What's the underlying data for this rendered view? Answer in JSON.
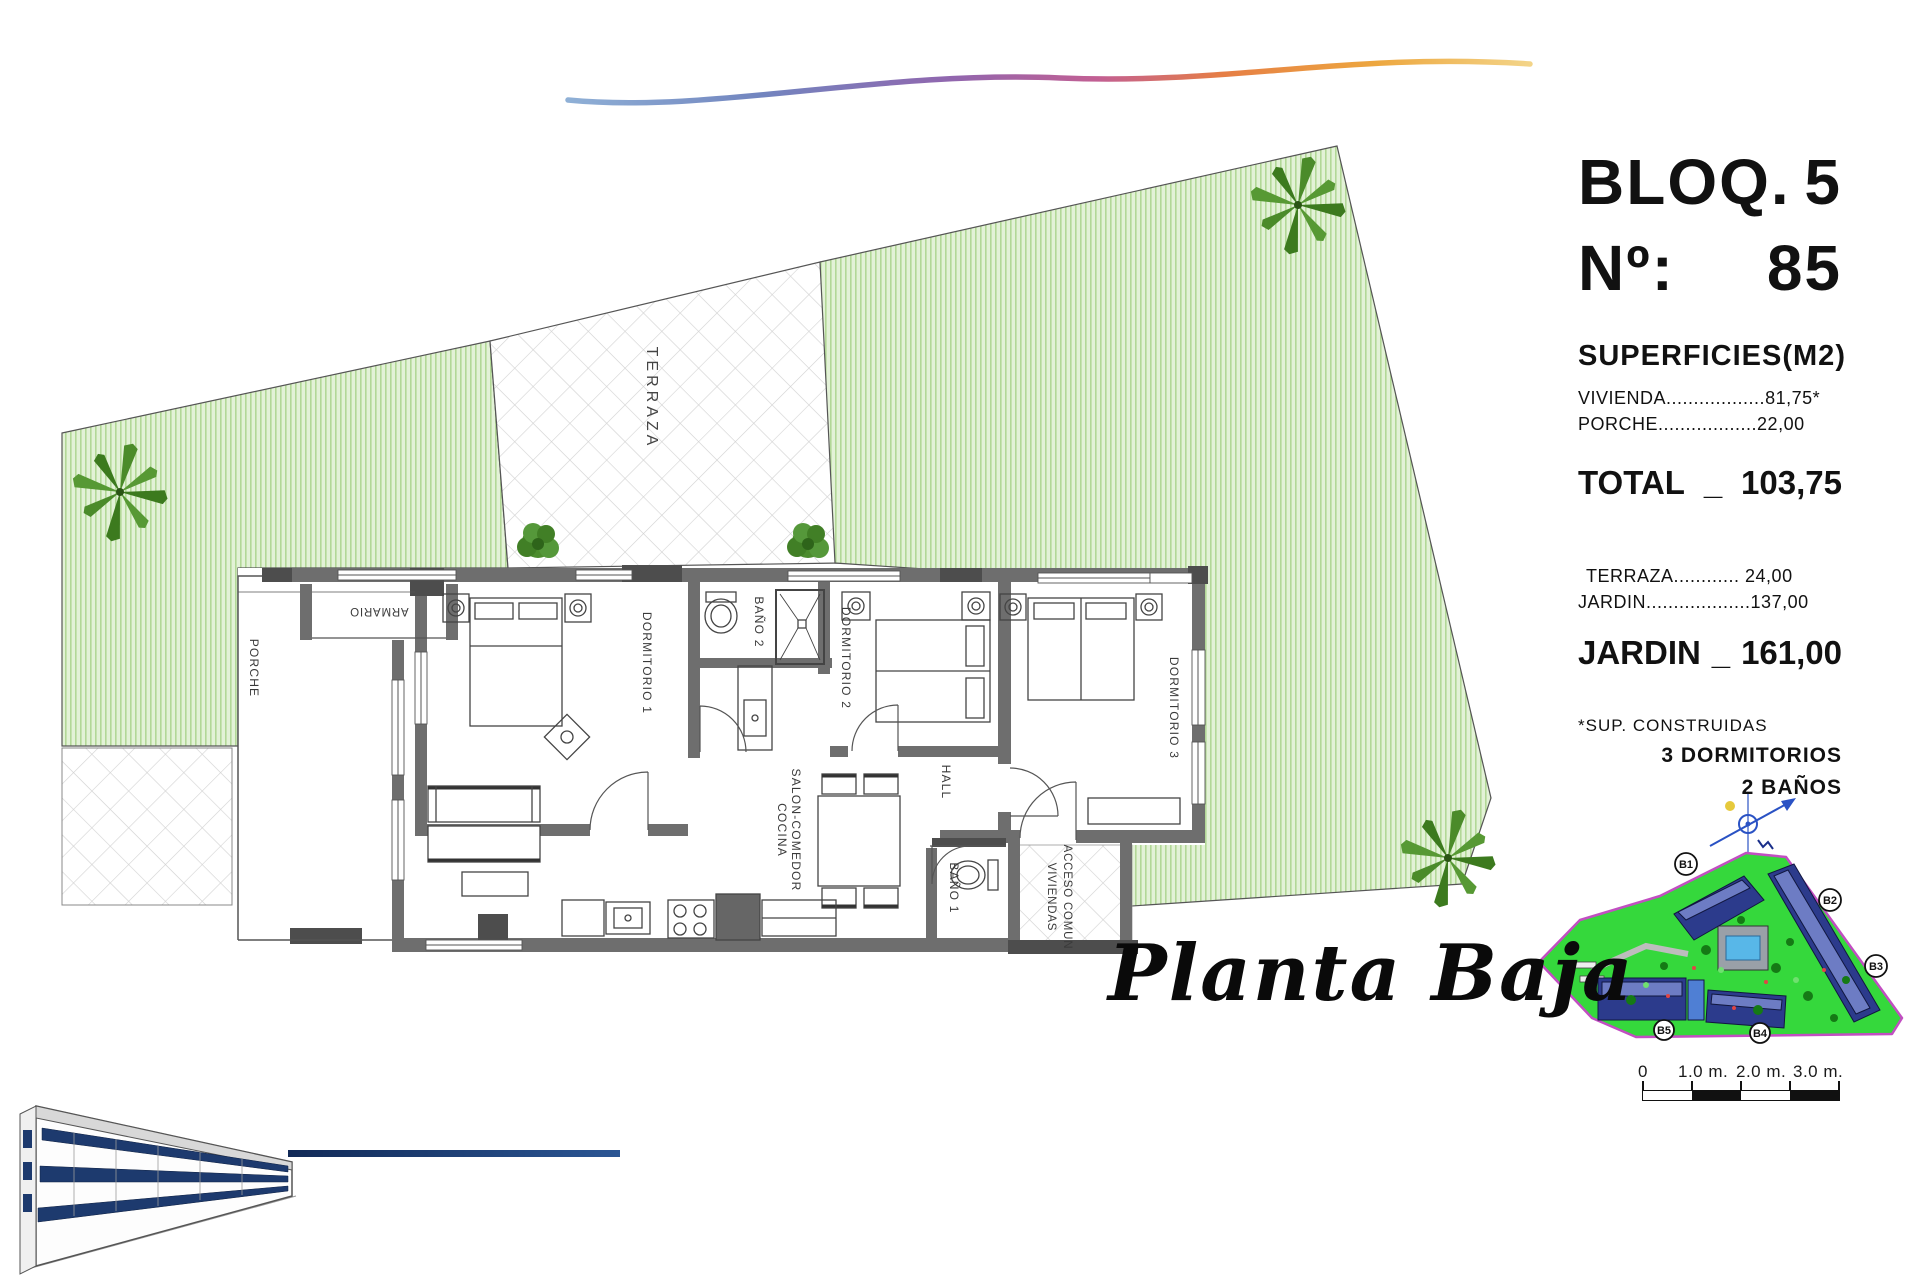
{
  "header": {
    "block": "BLOQ.",
    "block_num": "5",
    "num_label": "Nº:",
    "num_value": "85"
  },
  "surfaces": {
    "title": "SUPERFICIES(M2)",
    "rows": [
      {
        "label": "VIVIENDA",
        "dots": "..................",
        "value": "81,75*"
      },
      {
        "label": "PORCHE",
        "dots": "..................",
        "value": "22,00"
      }
    ],
    "total": {
      "label": "TOTAL",
      "sep": "_",
      "value": "103,75"
    },
    "outdoor": [
      {
        "label": "TERRAZA",
        "dots": "............ ",
        "value": "24,00"
      },
      {
        "label": "JARDIN",
        "dots": "...................",
        "value": "137,00"
      }
    ],
    "jardin": {
      "label": "JARDIN",
      "sep": "_",
      "value": "161,00"
    },
    "footnote": "*SUP. CONSTRUIDAS",
    "program": [
      "3 DORMITORIOS",
      "2 BAÑOS"
    ]
  },
  "floorplan": {
    "labels": {
      "terraza": "TERRAZA",
      "porche": "PORCHE",
      "armario": "ARMARIO",
      "dormitorio1": "DORMITORIO 1",
      "bano2": "BAÑO 2",
      "dormitorio2": "DORMITORIO 2",
      "dormitorio3": "DORMITORIO 3",
      "hall": "HALL",
      "bano1": "BAÑO 1",
      "salon1": "SALON-COMEDOR",
      "salon2": "COCINA",
      "acceso1": "ACCESO COMUN",
      "acceso2": "VIVIENDAS"
    }
  },
  "caption": "Planta Baja",
  "siteplan": {
    "blocks": [
      "B1",
      "B2",
      "B3",
      "B4",
      "B5"
    ]
  },
  "scalebar": {
    "ticks": [
      "0",
      "1.0 m.",
      "2.0 m.",
      "3.0 m."
    ]
  },
  "colors": {
    "garden_fill": "#e3f2d7",
    "garden_hatch": "#b2d897",
    "wall_gray": "#6e6e6e",
    "wall_dark": "#4d4d4d",
    "site_green": "#35d83c",
    "site_boundary": "#c24ec2",
    "building_navy": "#2c3b8c",
    "line_navy": "#122a57",
    "swoosh": [
      "#8fb0d6",
      "#9166ae",
      "#c25f93",
      "#e67e45",
      "#f3d488"
    ]
  }
}
